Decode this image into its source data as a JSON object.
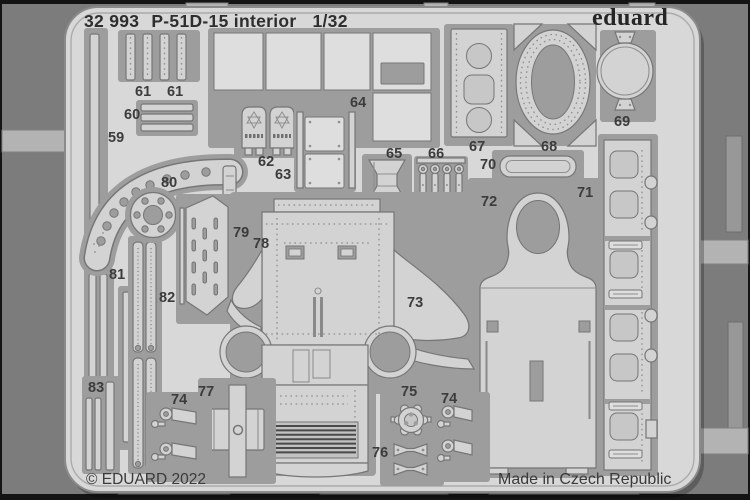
{
  "header": {
    "catalog_number": "32 993",
    "product_name": "P-51D-15 interior",
    "scale": "1/32",
    "brand_logo": "eduard"
  },
  "footer": {
    "copyright": "© EDUARD 2022",
    "origin": "Made in Czech Republic"
  },
  "colors": {
    "bg_outer": "#141414",
    "bg": "#7c7c7c",
    "sheet": "#d8d8d8",
    "sheet_edge": "#8a8a8a",
    "part": "#d3d3d3",
    "part_light": "#dedede",
    "void": "#9d9d9d",
    "outline": "#767676",
    "detail": "#8f8f8f",
    "recess": "#c7c7c7",
    "tab": "#b3b3b3",
    "tab_edge": "#7f7f7f",
    "text": "#2e2e2e",
    "text_soft": "#3c3c3c"
  },
  "part_labels": [
    {
      "label": "59",
      "x": 108,
      "y": 130
    },
    {
      "label": "61",
      "x": 135,
      "y": 84
    },
    {
      "label": "61",
      "x": 167,
      "y": 84
    },
    {
      "label": "60",
      "x": 124,
      "y": 107
    },
    {
      "label": "80",
      "x": 161,
      "y": 175
    },
    {
      "label": "79",
      "x": 233,
      "y": 225
    },
    {
      "label": "78",
      "x": 253,
      "y": 236
    },
    {
      "label": "81",
      "x": 109,
      "y": 267
    },
    {
      "label": "82",
      "x": 159,
      "y": 290
    },
    {
      "label": "83",
      "x": 88,
      "y": 380
    },
    {
      "label": "64",
      "x": 350,
      "y": 95
    },
    {
      "label": "62",
      "x": 258,
      "y": 154
    },
    {
      "label": "63",
      "x": 275,
      "y": 167
    },
    {
      "label": "65",
      "x": 386,
      "y": 146
    },
    {
      "label": "66",
      "x": 428,
      "y": 146
    },
    {
      "label": "67",
      "x": 469,
      "y": 139
    },
    {
      "label": "68",
      "x": 541,
      "y": 139
    },
    {
      "label": "69",
      "x": 614,
      "y": 114
    },
    {
      "label": "70",
      "x": 480,
      "y": 157
    },
    {
      "label": "71",
      "x": 577,
      "y": 185
    },
    {
      "label": "72",
      "x": 481,
      "y": 194
    },
    {
      "label": "73",
      "x": 407,
      "y": 295
    },
    {
      "label": "77",
      "x": 198,
      "y": 384
    },
    {
      "label": "74",
      "x": 171,
      "y": 392
    },
    {
      "label": "75",
      "x": 401,
      "y": 384
    },
    {
      "label": "76",
      "x": 372,
      "y": 445
    },
    {
      "label": "74",
      "x": 441,
      "y": 391
    }
  ]
}
